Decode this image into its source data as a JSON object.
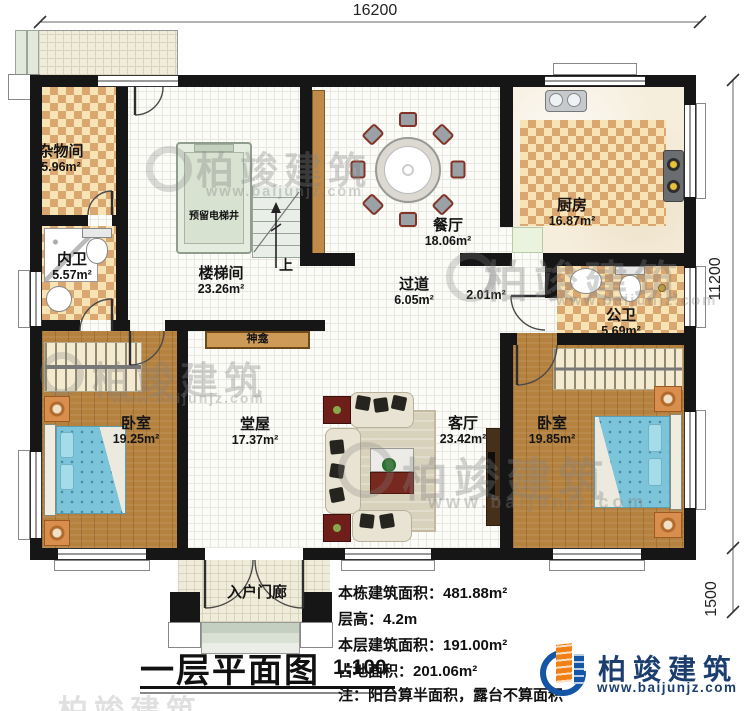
{
  "dims": {
    "top": "16200",
    "right_main": "11200",
    "right_porch": "1500"
  },
  "rooms": {
    "storage": {
      "name": "杂物间",
      "area": "5.96m²"
    },
    "inner_bath": {
      "name": "内卫",
      "area": "5.57m²"
    },
    "stair_hall": {
      "name": "楼梯间",
      "area": "23.26m²"
    },
    "elevator": {
      "name": "预留电梯井"
    },
    "dining": {
      "name": "餐厅",
      "area": "18.06m²"
    },
    "kitchen": {
      "name": "厨房",
      "area": "16.87m²"
    },
    "hallway": {
      "name": "过道",
      "area": "6.05m²"
    },
    "hallway_small": {
      "area": "2.01m²"
    },
    "public_bath": {
      "name": "公卫",
      "area": "5.69m²"
    },
    "shrine": {
      "name": "神龛"
    },
    "bedroom_left": {
      "name": "卧室",
      "area": "19.25m²"
    },
    "main_hall": {
      "name": "堂屋",
      "area": "17.37m²"
    },
    "living": {
      "name": "客厅",
      "area": "23.42m²"
    },
    "bedroom_right": {
      "name": "卧室",
      "area": "19.85m²"
    },
    "porch": {
      "name": "入户门廊"
    }
  },
  "stairs": {
    "up": "上"
  },
  "title_block": {
    "title": "一层平面图",
    "scale": "1:100"
  },
  "info_lines": [
    "本栋建筑面积：481.88m²",
    "层高：4.2m",
    "本层建筑面积：191.00m²",
    "占地面积：201.06m²",
    "注：阳台算半面积，露台不算面积"
  ],
  "brand": {
    "name": "柏竣建筑",
    "url": "www.baijunjz.com"
  },
  "watermark": {
    "name": "柏竣建筑",
    "url": "www.baijunjz.com"
  },
  "colors": {
    "wall": "#161616",
    "checker_dark": "#d9a76f",
    "checker_light": "#f7e3b4",
    "wood": "#b5813f",
    "brand_blue": "#1456a5",
    "brand_orange": "#f08015",
    "brand_text": "#1c3e6f",
    "bed_blue": "#7cc4da"
  }
}
